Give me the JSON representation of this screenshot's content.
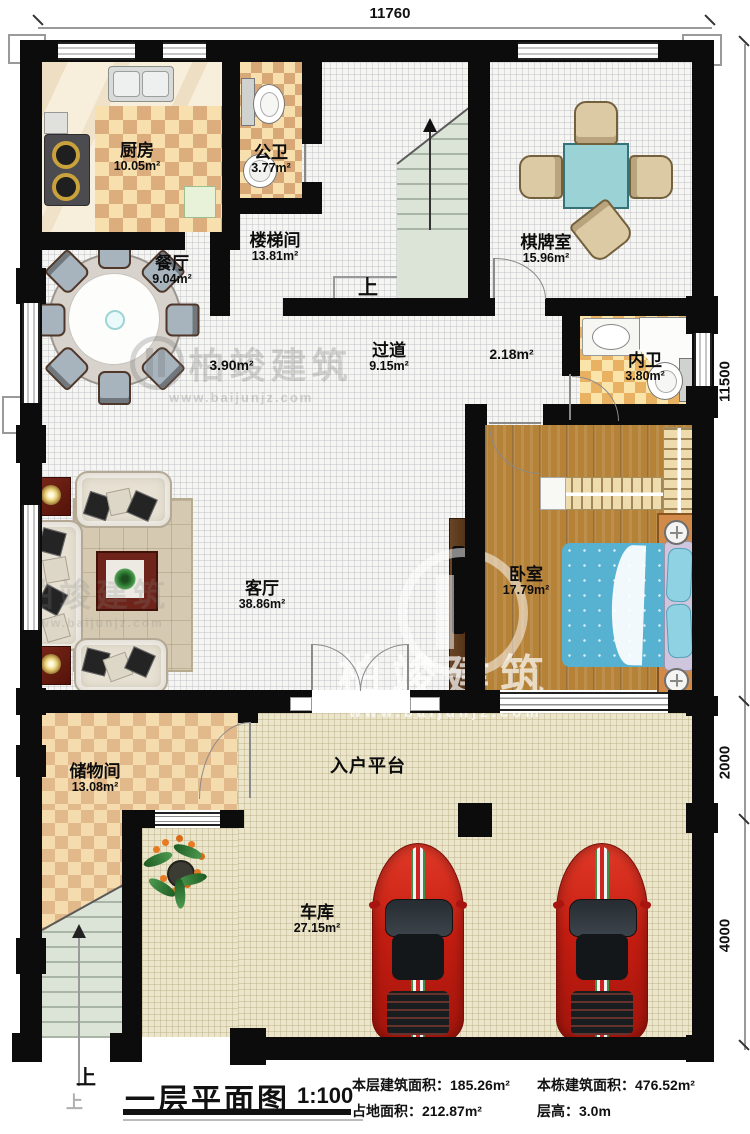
{
  "dimensions": {
    "top": "11760",
    "right_upper": "11500",
    "right_middle": "2000",
    "right_lower": "4000"
  },
  "rooms": {
    "kitchen": {
      "name": "厨房",
      "area": "10.05m²"
    },
    "public_bath": {
      "name": "公卫",
      "area": "3.77m²"
    },
    "stairwell": {
      "name": "楼梯间",
      "area": "13.81m²",
      "up": "上"
    },
    "chess_room": {
      "name": "棋牌室",
      "area": "15.96m²"
    },
    "dining": {
      "name": "餐厅",
      "area": "9.04m²"
    },
    "hallway": {
      "name": "过道",
      "area": "9.15m²",
      "sub_area_left": "3.90m²",
      "sub_area_right": "2.18m²"
    },
    "inner_bath": {
      "name": "内卫",
      "area": "3.80m²"
    },
    "bedroom": {
      "name": "卧室",
      "area": "17.79m²"
    },
    "living_room": {
      "name": "客厅",
      "area": "38.86m²"
    },
    "storage": {
      "name": "储物间",
      "area": "13.08m²"
    },
    "entry_platform": {
      "name": "入户平台"
    },
    "garage": {
      "name": "车库",
      "area": "27.15m²"
    }
  },
  "exterior_stair": {
    "up": "上",
    "up_faint": "上"
  },
  "watermark": {
    "brand": "柏竣建筑",
    "url": "www.baijunjz.com"
  },
  "footer": {
    "title": "一层平面图",
    "scale": "1:100",
    "stats": [
      {
        "label": "本层建筑面积：",
        "value": "185.26m²"
      },
      {
        "label": "本栋建筑面积：",
        "value": "476.52m²"
      },
      {
        "label": "占地面积：",
        "value": "212.87m²"
      },
      {
        "label": "层高：",
        "value": "3.0m"
      }
    ]
  }
}
